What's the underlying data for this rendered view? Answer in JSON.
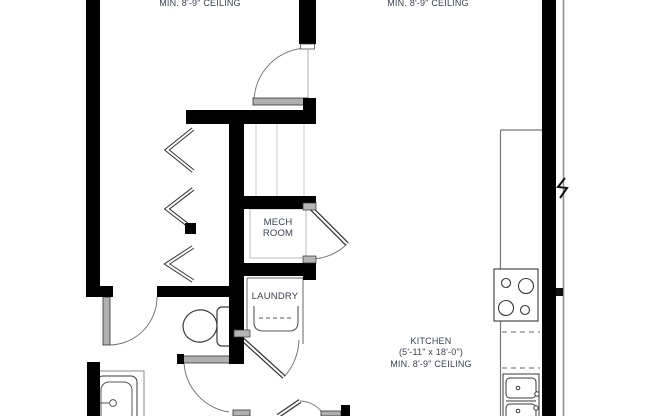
{
  "plan": {
    "ceiling_note_left": "MIN. 8'-9\" CEILING",
    "ceiling_note_right": "MIN. 8'-9\" CEILING",
    "mech_room": {
      "line1": "MECH",
      "line2": "ROOM"
    },
    "laundry_label": "LAUNDRY",
    "kitchen": {
      "title": "KITCHEN",
      "dims": "(5'-11\" x 18'-0\")",
      "ceiling": "MIN. 8'-9\" CEILING"
    }
  },
  "colors": {
    "wall": "#000000",
    "text": "#3a4150",
    "door_leaf": "#b0b0b0",
    "door_arc": "#777777",
    "fixture_line": "#3a3a3a",
    "soffit_line": "#c9c9c9"
  },
  "symbols": [
    "toilet-symbol",
    "bathtub-symbol",
    "washer-symbol",
    "cooktop-symbol",
    "double-sink-symbol",
    "kitchen-counter",
    "wall-break-symbol",
    "bifold-doors"
  ]
}
